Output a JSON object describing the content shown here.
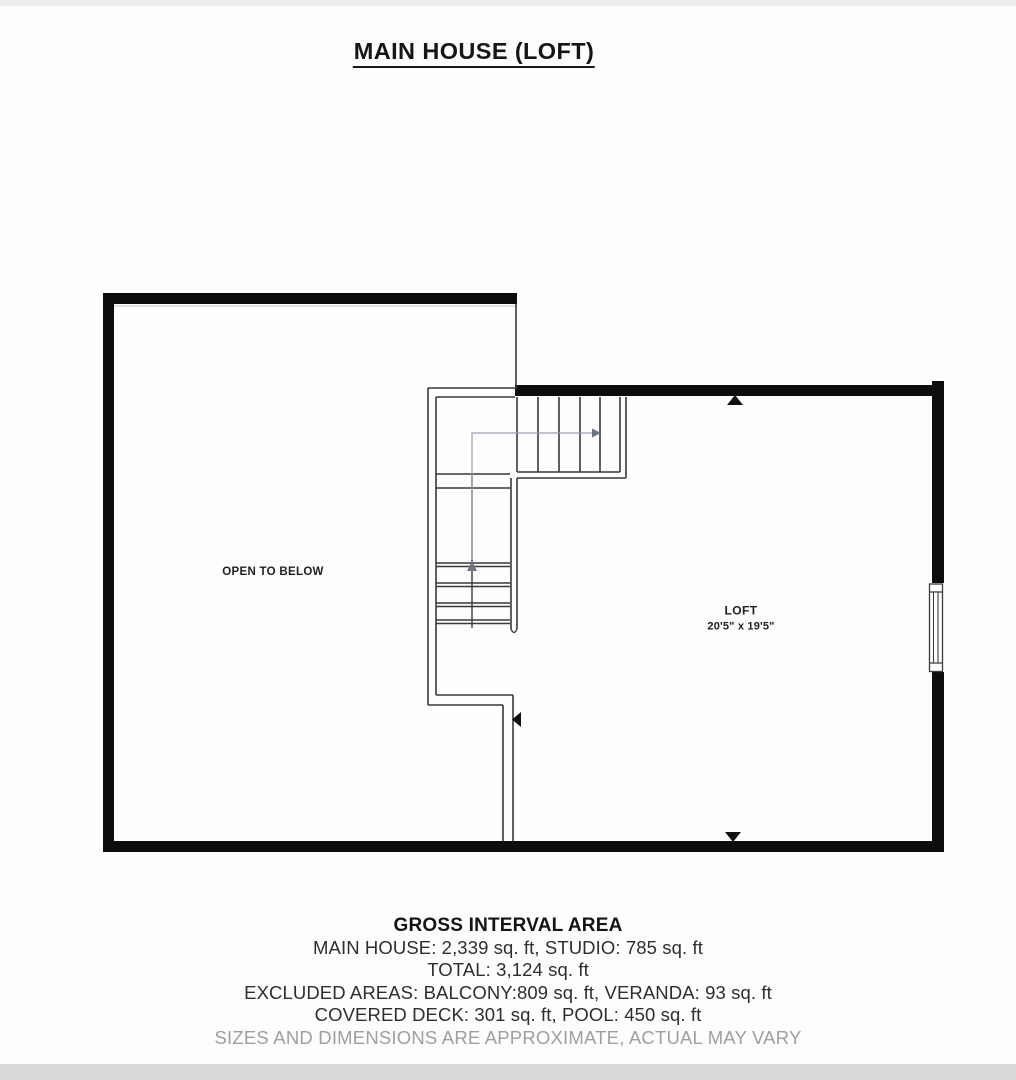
{
  "title": "MAIN HOUSE (LOFT)",
  "plan": {
    "room_labels": {
      "open_to_below": "OPEN TO BELOW",
      "loft_name": "LOFT",
      "loft_dimensions": "20'5\" x 19'5\""
    }
  },
  "footer": {
    "heading": "GROSS INTERVAL AREA",
    "lines": [
      "MAIN HOUSE: 2,339 sq. ft, STUDIO: 785 sq. ft",
      "TOTAL: 3,124 sq. ft",
      "EXCLUDED AREAS: BALCONY:809 sq. ft, VERANDA: 93 sq. ft",
      "COVERED DECK: 301 sq. ft, POOL: 450 sq. ft"
    ],
    "disclaimer": "SIZES AND DIMENSIONS ARE APPROXIMATE, ACTUAL MAY VARY"
  },
  "colors": {
    "wall": "#0d0d0d",
    "thin_line": "#3a3a3a",
    "guide_line": "#99a1ae",
    "marker": "#111111",
    "disclaimer_text": "#9d9fa1",
    "background": "#fdfdfd"
  }
}
